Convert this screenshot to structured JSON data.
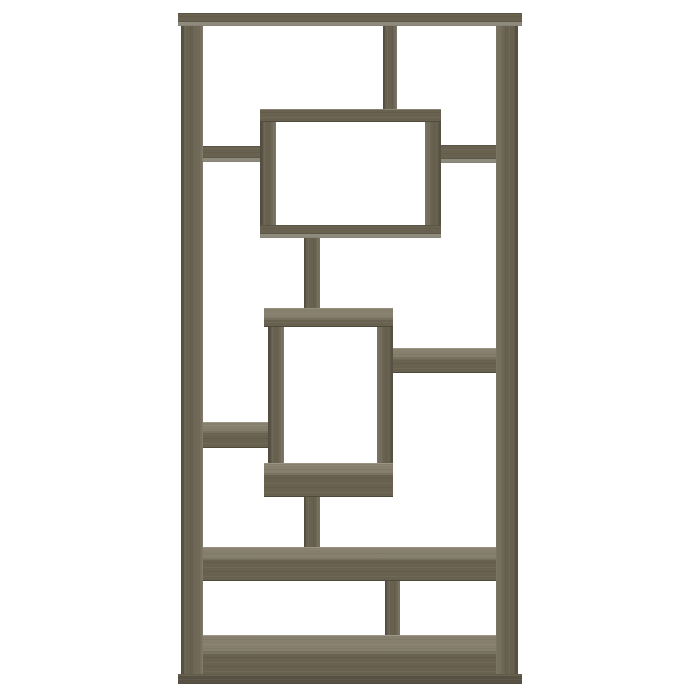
{
  "scene": {
    "description": "Product photo of a weathered grey geometric 10-shelf bookcase with interlocking rectangular openings, centered on a plain white background",
    "background": "#ffffff"
  },
  "palette": {
    "bg": "#ffffff",
    "face": "#68614f",
    "face_dark": "#575144",
    "face_light": "#777060",
    "top": "#867f6e",
    "top_highlight": "#9b9483",
    "underside": "#8e8a7c",
    "inner_face": "#837d6e"
  },
  "bookcase": {
    "bounds": {
      "x": 178,
      "y": 13,
      "w": 344,
      "h": 671
    },
    "parts": [
      {
        "name": "left-side-panel",
        "x": 181,
        "y": 26,
        "w": 22,
        "h": 649,
        "cls": "vgrain inner-r"
      },
      {
        "name": "right-side-panel",
        "x": 496,
        "y": 26,
        "w": 22,
        "h": 649,
        "cls": "vgrain inner-l"
      },
      {
        "name": "top-divider-post",
        "x": 383,
        "y": 26,
        "w": 14,
        "h": 84,
        "cls": "vgrain vboard"
      },
      {
        "name": "top-board",
        "x": 178,
        "y": 13,
        "w": 344,
        "h": 13,
        "cls": "hgrain hface under-edge"
      },
      {
        "name": "upper-box-left-side",
        "x": 260,
        "y": 122,
        "w": 16,
        "h": 104,
        "cls": "vgrain inner-r"
      },
      {
        "name": "upper-box-right-side",
        "x": 425,
        "y": 122,
        "w": 16,
        "h": 104,
        "cls": "vgrain inner-l"
      },
      {
        "name": "upper-box-top-shelf",
        "x": 260,
        "y": 109,
        "w": 181,
        "h": 13,
        "cls": "hgrain hface top-edge"
      },
      {
        "name": "upper-box-bottom-shelf",
        "x": 260,
        "y": 225,
        "w": 181,
        "h": 13,
        "cls": "hgrain hface under-edge"
      },
      {
        "name": "upper-left-shelf",
        "x": 203,
        "y": 146,
        "w": 57,
        "h": 16,
        "cls": "hgrain hface under-edge"
      },
      {
        "name": "upper-right-shelf",
        "x": 441,
        "y": 145,
        "w": 55,
        "h": 18,
        "cls": "hgrain hface under-edge"
      },
      {
        "name": "center-post-upper",
        "x": 304,
        "y": 238,
        "w": 16,
        "h": 71,
        "cls": "vgrain vboard"
      },
      {
        "name": "lower-box-left-side",
        "x": 268,
        "y": 327,
        "w": 16,
        "h": 137,
        "cls": "vgrain inner-r"
      },
      {
        "name": "lower-box-right-side",
        "x": 377,
        "y": 327,
        "w": 16,
        "h": 137,
        "cls": "vgrain inner-l"
      },
      {
        "name": "lower-box-top-shelf",
        "x": 264,
        "y": 308,
        "w": 129,
        "h": 19,
        "cls": "hgrain htop band10"
      },
      {
        "name": "lower-box-bottom-shelf",
        "x": 264,
        "y": 463,
        "w": 129,
        "h": 34,
        "cls": "hgrain htop band10"
      },
      {
        "name": "right-mid-shelf",
        "x": 393,
        "y": 348,
        "w": 103,
        "h": 25,
        "cls": "hgrain htop band9"
      },
      {
        "name": "left-mid-shelf",
        "x": 203,
        "y": 422,
        "w": 65,
        "h": 26,
        "cls": "hgrain htop band9"
      },
      {
        "name": "center-post-lower",
        "x": 304,
        "y": 497,
        "w": 16,
        "h": 51,
        "cls": "vgrain vboard"
      },
      {
        "name": "long-shelf",
        "x": 203,
        "y": 547,
        "w": 293,
        "h": 34,
        "cls": "hgrain htop band11"
      },
      {
        "name": "lower-divider-post",
        "x": 385,
        "y": 581,
        "w": 15,
        "h": 55,
        "cls": "vgrain vboard"
      },
      {
        "name": "bottom-shelf",
        "x": 203,
        "y": 635,
        "w": 293,
        "h": 41,
        "cls": "hgrain htop band18"
      },
      {
        "name": "base-strip",
        "x": 178,
        "y": 674,
        "w": 344,
        "h": 10,
        "cls": "hgrain dark"
      }
    ]
  }
}
